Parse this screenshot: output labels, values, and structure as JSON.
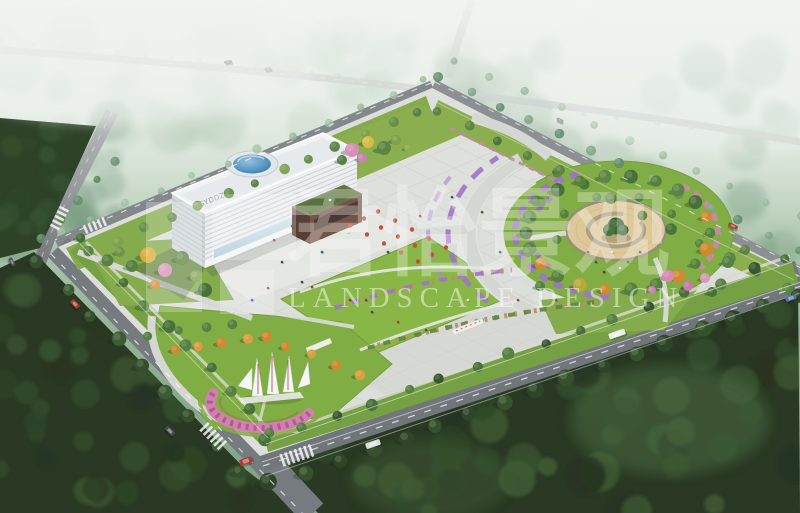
{
  "meta": {
    "title": "Aerial landscape design rendering of a civic plaza and park",
    "view": "bird's-eye perspective"
  },
  "watermark": {
    "brand_cn": "君怡景观",
    "brand_en": "LANDSCAPE DESIGN"
  },
  "building": {
    "sign": "GYDDZ"
  },
  "palette": {
    "fog": "#eef2ee",
    "distant_forest": "#8fb291",
    "dark_forest": "#22351d",
    "road": "#73787c",
    "paving": "#dcdeda",
    "lawn": "#83b43f",
    "lawn_dark": "#74a437",
    "sand_plaza": "#dcc795",
    "purple_flowers": "#9b6fc4",
    "pink_flowers": "#d07fae",
    "orange_tree": "#cf8427",
    "yellow_tree": "#d9b83a",
    "green_tree": "#4e7c38",
    "building_facade": "#eceff1",
    "dome_blue": "#3f7fb0",
    "annex_brown": "#6b4d3e",
    "annex_roof": "#557033",
    "sculpture_white": "#f6f8f8",
    "path": "#d4d6d1"
  }
}
